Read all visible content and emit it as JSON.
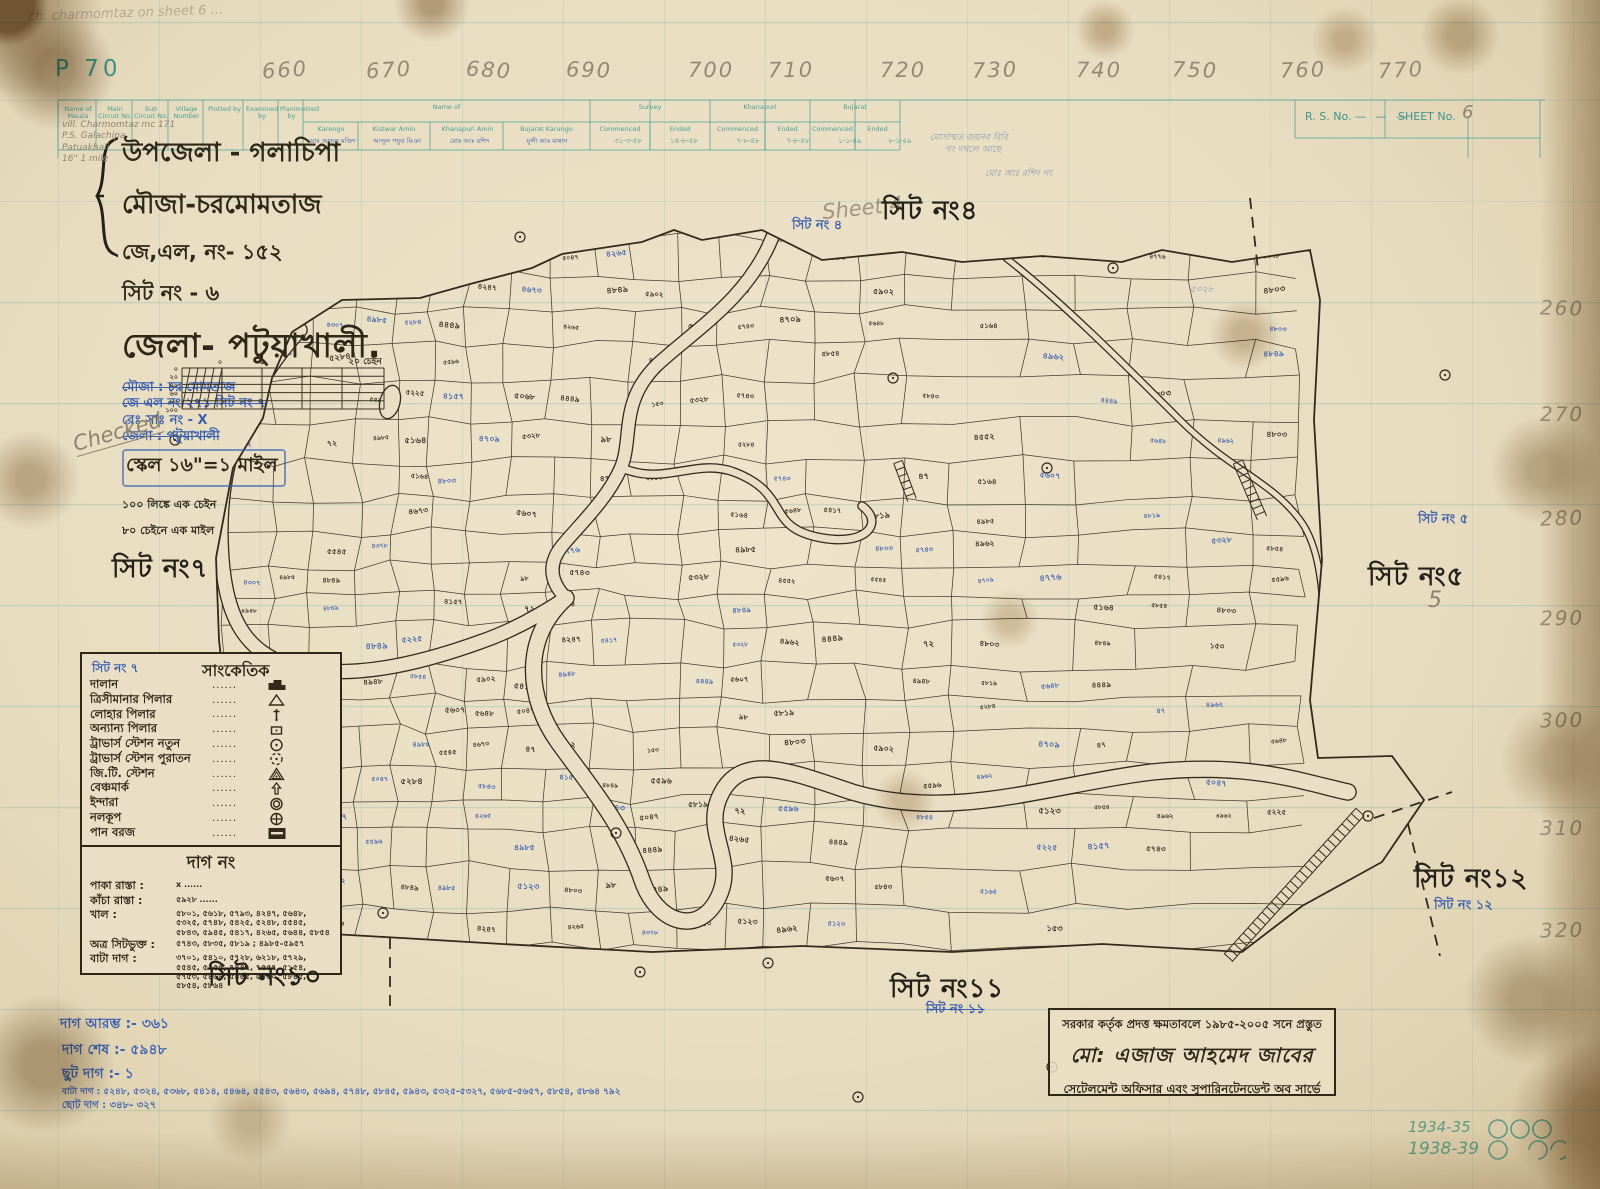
{
  "meta": {
    "plate_no": "P 70",
    "rs_label": "R. S. No.",
    "sheet_label": "SHEET No.",
    "sheet_value": "6",
    "corner_note": "ch. charmomtaz  on  sheet 6 ...",
    "checked_note": "Checked",
    "sheet4_pencil": "Sheet 4",
    "pencil_5": "5",
    "years": [
      "1934-35",
      "1938-39"
    ]
  },
  "ruler_top": [
    {
      "t": "660",
      "x": 262
    },
    {
      "t": "670",
      "x": 366
    },
    {
      "t": "680",
      "x": 466
    },
    {
      "t": "690",
      "x": 566
    },
    {
      "t": "700",
      "x": 688
    },
    {
      "t": "710",
      "x": 768
    },
    {
      "t": "720",
      "x": 880
    },
    {
      "t": "730",
      "x": 972
    },
    {
      "t": "740",
      "x": 1076
    },
    {
      "t": "750",
      "x": 1172
    },
    {
      "t": "760",
      "x": 1280
    },
    {
      "t": "770",
      "x": 1378
    }
  ],
  "ruler_right": [
    {
      "t": "260",
      "y": 296
    },
    {
      "t": "270",
      "y": 402
    },
    {
      "t": "280",
      "y": 506
    },
    {
      "t": "290",
      "y": 606
    },
    {
      "t": "300",
      "y": 708
    },
    {
      "t": "310",
      "y": 816
    },
    {
      "t": "320",
      "y": 918
    }
  ],
  "table": {
    "cols": [
      {
        "t": "Name of Mauza",
        "x": 60,
        "w": 36
      },
      {
        "t": "Main Circuit No.",
        "x": 98,
        "w": 34
      },
      {
        "t": "Sub Circuit No.",
        "x": 134,
        "w": 34
      },
      {
        "t": "Village Number",
        "x": 170,
        "w": 33
      },
      {
        "t": "Plotted by",
        "x": 206,
        "w": 37
      },
      {
        "t": "Examined by",
        "x": 246,
        "w": 32
      },
      {
        "t": "Planimetred by",
        "x": 280,
        "w": 23
      }
    ],
    "name_of": "Name of",
    "name_of_sub": [
      "Karengo",
      "Kistwar Amin",
      "Khanapuri Amin",
      "Bujarat Karungo"
    ],
    "survey": "Survey",
    "khanapuri": "Khanapuri",
    "bujarat": "Bujarat",
    "commenced": "Commenced",
    "ended": "Ended",
    "dates": [
      {
        "t": "৩১-৩-৪৮",
        "x": 602
      },
      {
        "t": "১৪-৮-৪৮",
        "x": 658
      },
      {
        "t": "৭-৮-৪৮",
        "x": 722
      },
      {
        "t": "৭-৮-৪৮",
        "x": 772
      },
      {
        "t": "১-১-৪৯",
        "x": 824
      },
      {
        "t": "৮-১-৪৯",
        "x": 874
      }
    ],
    "blue_names": [
      "মোঃ আব্দুল মজিদ",
      "আব্দুল গফুর মিঞা",
      "মোঃ আঃ রশিদ",
      "মুন্সী আঃ মান্নান"
    ],
    "mauza_note": [
      "vill. Charmomtaz  mc 171",
      "P.S. Galachipa",
      "Patuakhali",
      "16\" 1 mile"
    ]
  },
  "title_block": {
    "line1": "উপজেলা - গলাচিপা",
    "line2": "মৌজা-চরমোমতাজ",
    "line3": "জে,এল, নং- ১৫২",
    "line4": "সিট নং -  ৬",
    "district": "জেলা- পটুয়াখালী.",
    "blue_lines": [
      {
        "t": "মৌজা : চর মোমতাজ",
        "strike": true
      },
      {
        "t": "জে এল নং ২৭১ সিট নং ৭",
        "strike": true
      },
      {
        "t": "রেঃ সাঃ নং -  X",
        "strike": false
      },
      {
        "t": "জেলা : পটুয়াখালী",
        "strike": true
      }
    ],
    "scale": "স্কেল ১৬\"=১ মাইল",
    "scale_note1": "১০০ লিঙ্কে এক চেইন",
    "scale_note2": "৮০ চেইনে এক মাইল",
    "scale_bar": {
      "left_ticks": [
        "০",
        "২০",
        "৪০",
        "৬০",
        "৮০",
        "১০০"
      ],
      "zero": "০",
      "five": "৫",
      "right": "২০ চেইন"
    }
  },
  "legend": {
    "title": "সাংকেতিক",
    "blue_overlap": "সিট নং ৭",
    "dots": "......",
    "items": [
      {
        "label": "দালান",
        "icon": "building-icon"
      },
      {
        "label": "ত্রিসীমানার পিলার",
        "icon": "boundary-pillar-icon"
      },
      {
        "label": "লোহার পিলার",
        "icon": "iron-pillar-icon"
      },
      {
        "label": "অন্যান্য পিলার",
        "icon": "other-pillar-icon"
      },
      {
        "label": "ট্রাভার্স স্টেশন নতুন",
        "icon": "traverse-new-icon"
      },
      {
        "label": "ট্রাভার্স স্টেশন পুরাতন",
        "icon": "traverse-old-icon"
      },
      {
        "label": "জি.টি. স্টেশন",
        "icon": "gt-station-icon"
      },
      {
        "label": "বেঞ্চমার্ক",
        "icon": "benchmark-icon"
      },
      {
        "label": "ইন্দারা",
        "icon": "well-icon"
      },
      {
        "label": "নলকূপ",
        "icon": "tubewell-icon"
      },
      {
        "label": "পান বরজ",
        "icon": "pan-boroj-icon"
      }
    ]
  },
  "dag_box": {
    "title": "দাগ নং",
    "rows": [
      {
        "label": "পাকা রাস্তা :",
        "value": "x   ......"
      },
      {
        "label": "কাঁচা রাস্তা :",
        "value": "৫৯২৮ ......"
      },
      {
        "label": "খাল :",
        "value": "৫৮০১, ৫৬১৮, ৫৭৯৩, ৪২৪৭, ৫৬৪৮, ৫৩২৫, ৫৭৪৮, ৫৪২৫, ৫২৪৮, ৫৫৪৫, ৫৮৪৩, ৫৯৪৫, ৫৪১৭, ৪২৬৫, ৫৬৪৪, ৫৮৫৪"
      },
      {
        "label": "অত্র সিটভুক্ত :",
        "value": "৫৭৪৩, ৫৮৩৫, ৫৮১৯ ; ৪৯৮৫–৫৯৫৭"
      },
      {
        "label": "বাটা দাগ :",
        "value": "৩৭০১, ৫৪১০, ৫৭২৮, ৬২১৮, ৫৭২৯, ৫৫৪৫, ৫২৫৫, ৭৪৪৭, ৭৫৫৭, ৫১৫৪, ৫৭৫৩, ৫৪৬৪, ৫৪৬৫, ৫৮৬০, ৫৮৪৫, ৫৮৫৪, ৫৮৬৪"
      }
    ]
  },
  "sheet_labels": [
    {
      "t": "সিট নং৭",
      "x": 112,
      "y": 548
    },
    {
      "t": "সিট নং৪",
      "x": 882,
      "y": 190
    },
    {
      "t": "সিট নং৫",
      "x": 1368,
      "y": 556
    },
    {
      "t": "সিট নং১০",
      "x": 208,
      "y": 956
    },
    {
      "t": "সিট নং১১",
      "x": 890,
      "y": 968
    },
    {
      "t": "সিট নং১২",
      "x": 1414,
      "y": 858
    }
  ],
  "blue_labels": [
    {
      "t": "সিট নং ৪",
      "x": 792,
      "y": 216,
      "strike": false
    },
    {
      "t": "সিট নং ৫",
      "x": 1418,
      "y": 510,
      "strike": false
    },
    {
      "t": "সিট নং ১১",
      "x": 926,
      "y": 1000,
      "strike": true
    },
    {
      "t": "সিট নং ১২",
      "x": 1434,
      "y": 896,
      "strike": false
    }
  ],
  "stamp": {
    "line1": "সরকার কর্তৃক প্রদত্ত ক্ষমতাবলে ১৯৮৫-২০০৫ সনে প্রস্তুত",
    "line2": "মো: এজাজ আহমেদ জাবের",
    "line3": "সেটেলমেন্ট অফিসার এবং সুপারিনটেনডেন্ট অব সার্ভে"
  },
  "footer_blue": [
    {
      "t": "দাগ আরম্ভ :- ৩৬১",
      "x": 60,
      "y": 1012,
      "s": 14
    },
    {
      "t": "দাগ শেষ :- ৫৯৪৮",
      "x": 62,
      "y": 1038,
      "s": 14
    },
    {
      "t": "ছুট দাগ :- ১",
      "x": 62,
      "y": 1062,
      "s": 14
    },
    {
      "t": "বাটা দাগ : ৫২৪৮, ৫৩২৪, ৫৩৬৮, ৫৪১৪, ৫৪৬৪, ৫৫৪৩, ৫৬৪৩, ৫৬৯৪, ৫৭৪৮, ৫৮৪৫, ৫৯৪৩, ৫৩২৫-৫৩২৭, ৫৬৮৫-৫৬৫৭, ৫৮৫৪, ৫৮৬৪  ৭৯২",
      "x": 62,
      "y": 1084,
      "s": 9
    },
    {
      "t": "ছোট দাগ : ৩৪৮-  ৩২৭",
      "x": 62,
      "y": 1098,
      "s": 10
    }
  ],
  "map": {
    "ink": "#332a1c",
    "blue": "#3f62b0",
    "paper": "#eadfc4",
    "plot_numbers_sample": [
      "৪৮৪৯",
      "৫১২৩",
      "৫০৪৭",
      "৪৯৬২",
      "৫৬৪৮",
      "৫২২৫",
      "৪৩০৭",
      "৫৮৪৩",
      "৪১৫৭",
      "৫৯০২",
      "৪৭৭৬",
      "৫৫৪৫",
      "৪২৬৫",
      "৫৩২৮",
      "৪৯৮৫",
      "৫৭৪৩",
      "৪৪৪৯",
      "৫০৬৮",
      "৪৬৭৩",
      "৫৮১৯",
      "৪৫৫২",
      "৫২৮৪",
      "৪৮০৩",
      "৫৪১৭",
      "৪৯৪৮",
      "৫৬০৭",
      "৪৩৭৮",
      "৫১৬৪",
      "৪৭০৯",
      "৫৫৯৬",
      "৯৮",
      "৭২",
      "৪৭",
      "১৫৩",
      "৫৮৫৪",
      "৪২৪৭"
    ]
  }
}
